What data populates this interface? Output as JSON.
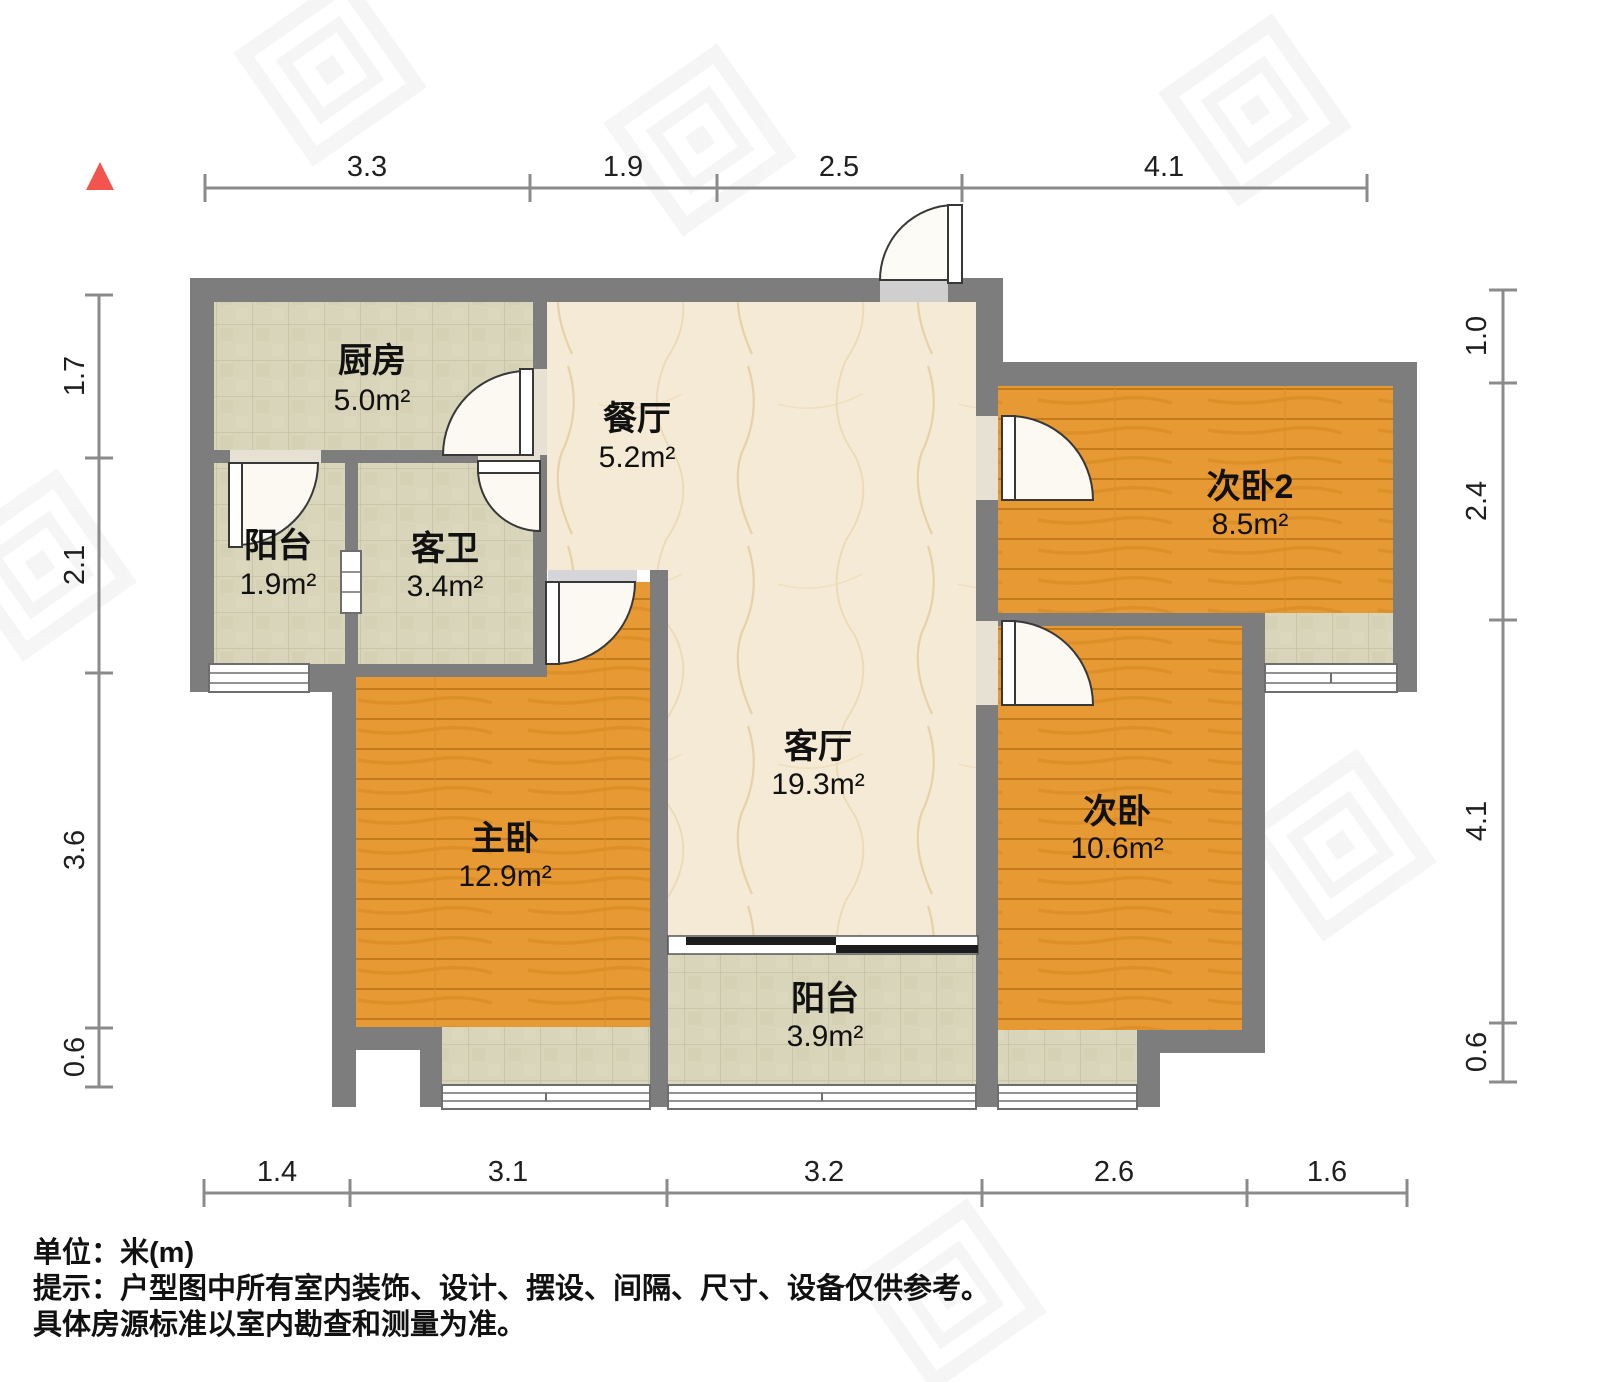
{
  "marker": {
    "shape": "triangle",
    "color": "#f2544e"
  },
  "rooms": [
    {
      "name": "厨房",
      "area": "5.0m²"
    },
    {
      "name": "餐厅",
      "area": "5.2m²"
    },
    {
      "name": "阳台",
      "area": "1.9m²"
    },
    {
      "name": "客卫",
      "area": "3.4m²"
    },
    {
      "name": "次卧2",
      "area": "8.5m²"
    },
    {
      "name": "主卧",
      "area": "12.9m²"
    },
    {
      "name": "客厅",
      "area": "19.3m²"
    },
    {
      "name": "次卧",
      "area": "10.6m²"
    },
    {
      "name": "阳台",
      "area": "3.9m²"
    }
  ],
  "dims": {
    "top": [
      "3.3",
      "1.9",
      "2.5",
      "4.1"
    ],
    "left": [
      "1.7",
      "2.1",
      "3.6",
      "0.6"
    ],
    "right": [
      "1.0",
      "2.4",
      "4.1",
      "0.6"
    ],
    "bottom": [
      "1.4",
      "3.1",
      "3.2",
      "2.6",
      "1.6"
    ]
  },
  "notes": {
    "unit": "单位：米(m)",
    "tip1": "提示：户型图中所有室内装饰、设计、摆设、间隔、尺寸、设备仅供参考。",
    "tip2": "具体房源标准以室内勘查和测量为准。"
  },
  "colors": {
    "wall": "#7d7d7d",
    "wood": "#e79a33",
    "tile": "#d9d5ba",
    "marble": "#f4ead5",
    "accent": "#f2544e"
  }
}
